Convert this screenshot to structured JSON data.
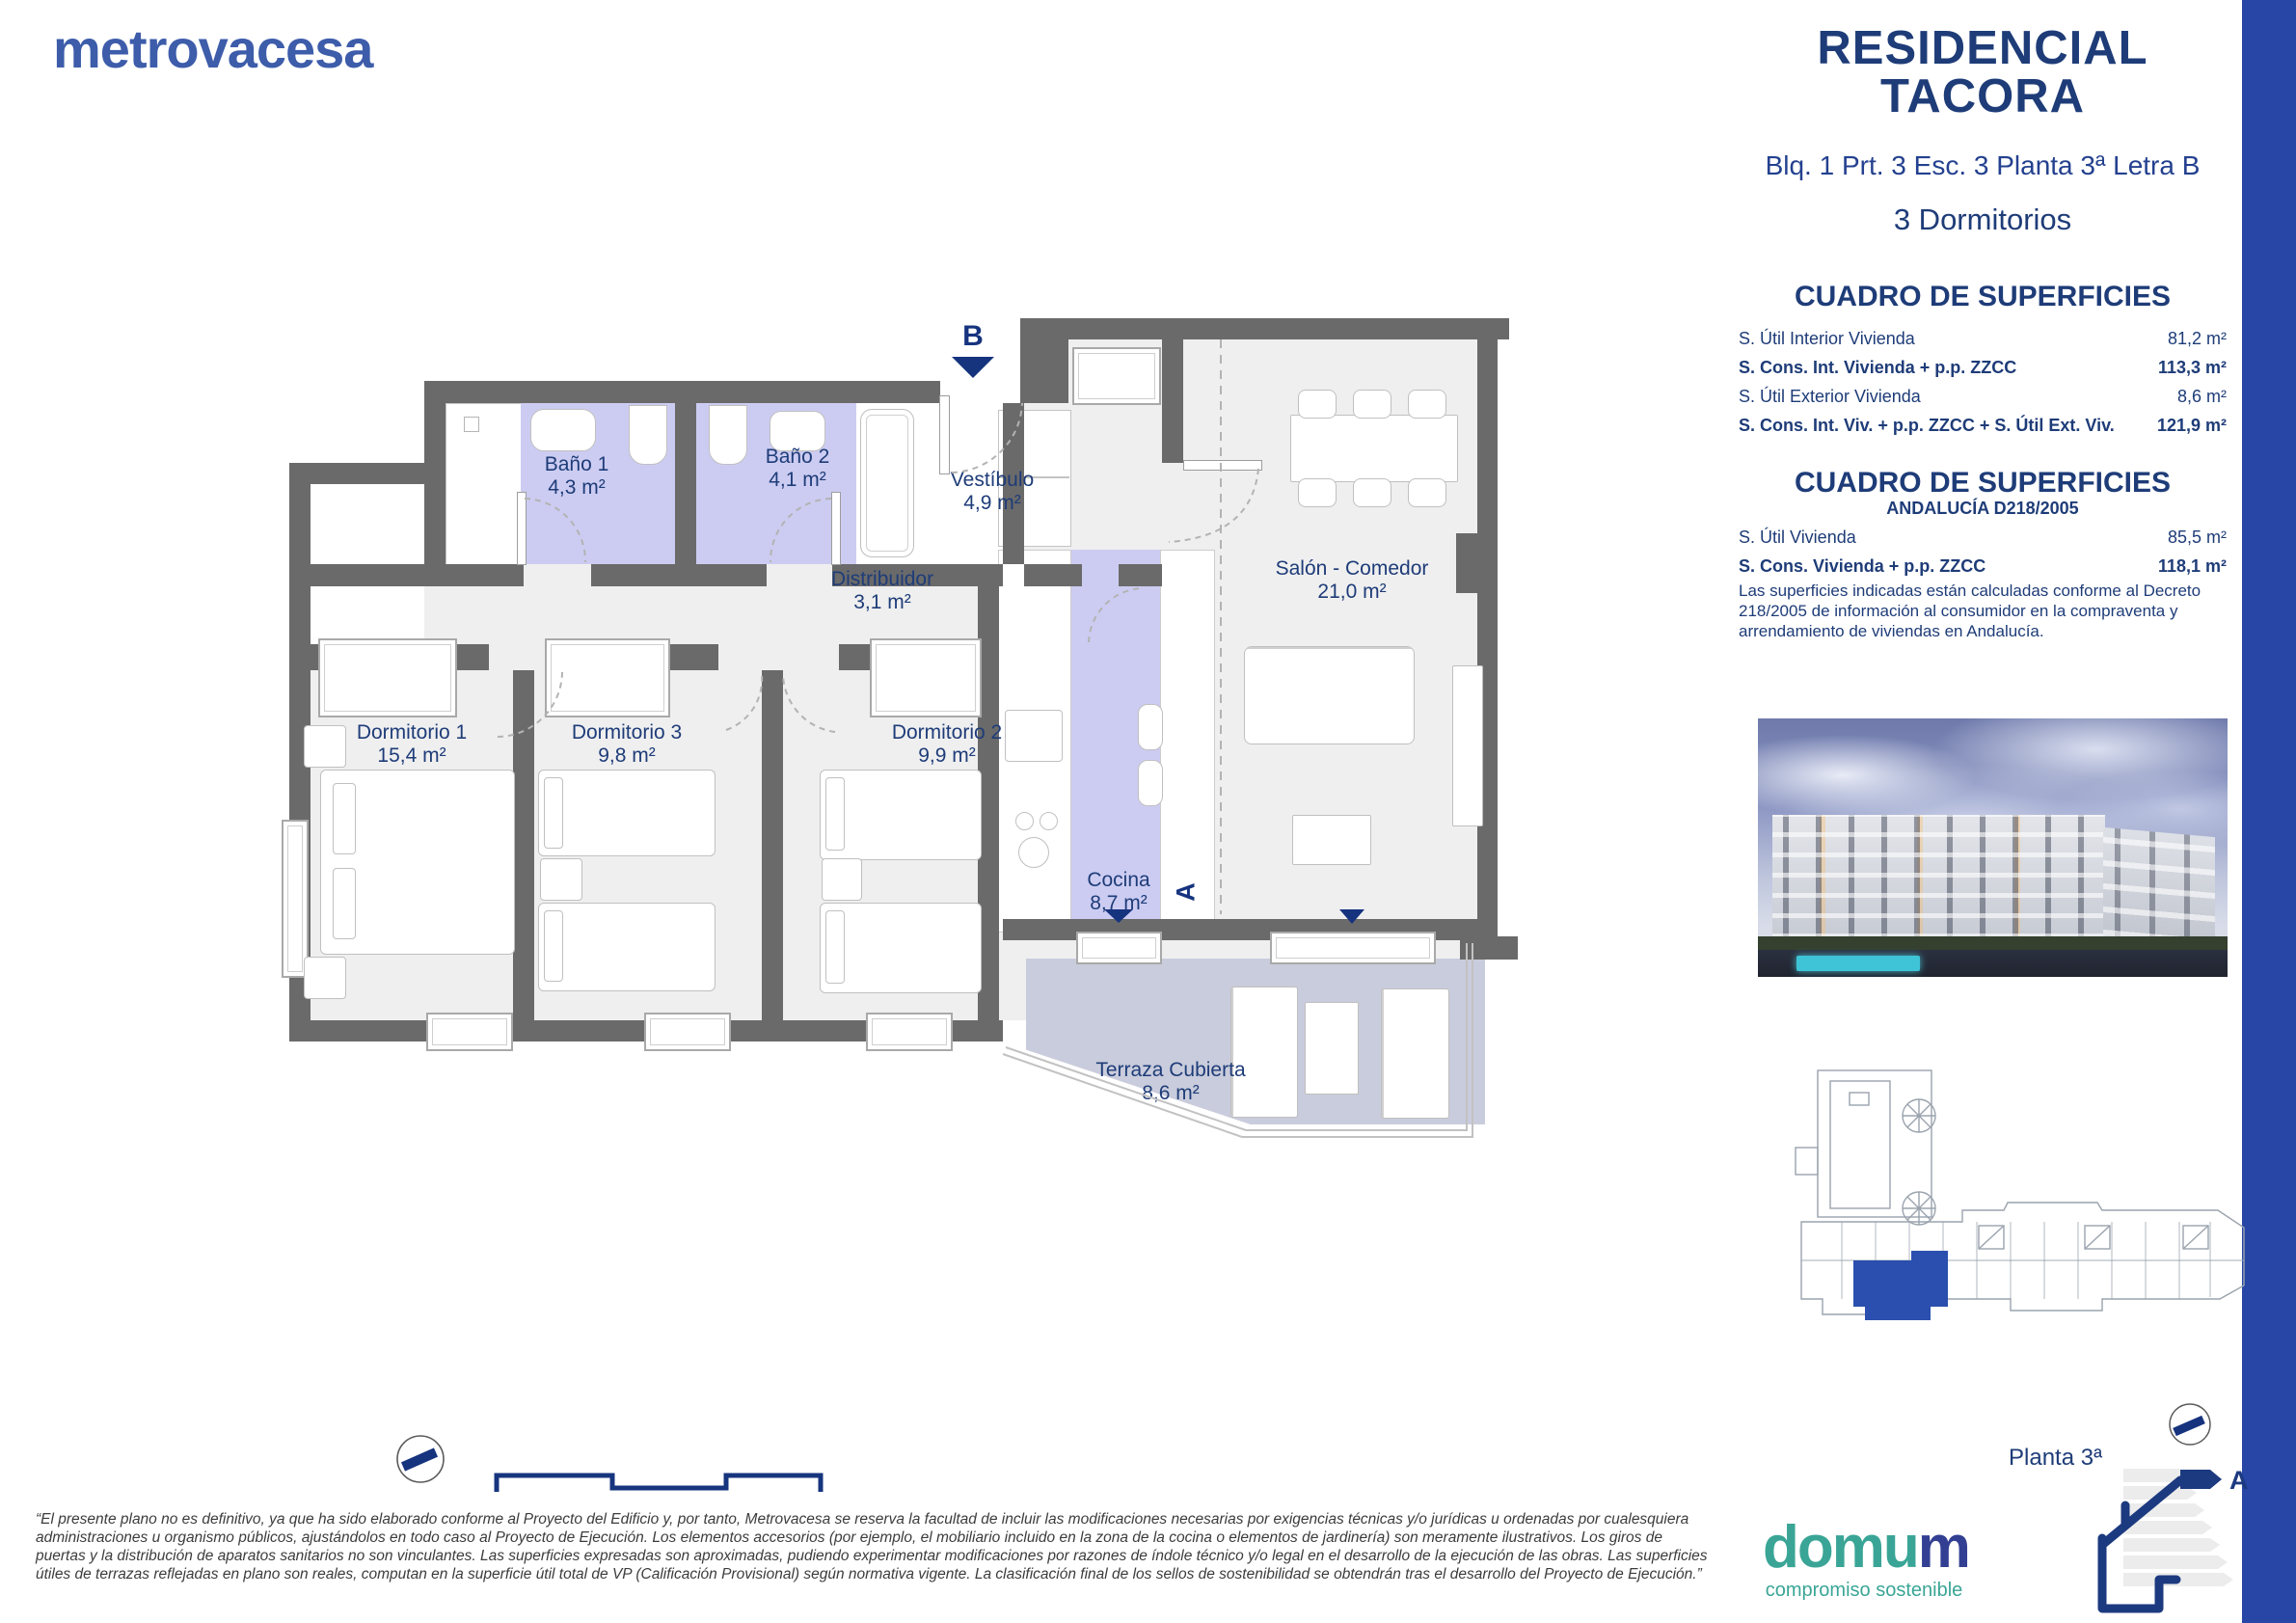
{
  "brand": {
    "logo_text": "metrovacesa",
    "logo_color": "#3d5caa"
  },
  "header": {
    "title_line1": "RESIDENCIAL",
    "title_line2": "TACORA",
    "subtitle": "Blq. 1 Prt. 3 Esc. 3 Planta 3ª Letra B",
    "typology": "3 Dormitorios"
  },
  "surfaces_main": {
    "title": "CUADRO DE SUPERFICIES",
    "rows": [
      {
        "label": "S. Útil Interior Vivienda",
        "value": "81,2 m²"
      },
      {
        "label": "S. Cons. Int. Vivienda + p.p. ZZCC",
        "value": "113,3 m²"
      },
      {
        "label": "S. Útil Exterior Vivienda",
        "value": "8,6 m²"
      },
      {
        "label": "S. Cons. Int. Viv. + p.p. ZZCC + S. Útil Ext. Viv.",
        "value": "121,9 m²"
      }
    ]
  },
  "surfaces_andalucia": {
    "title": "CUADRO DE SUPERFICIES",
    "subtitle": "ANDALUCÍA D218/2005",
    "rows": [
      {
        "label": "S. Útil Vivienda",
        "value": "85,5 m²"
      },
      {
        "label": "S. Cons. Vivienda + p.p. ZZCC",
        "value": "118,1 m²"
      }
    ],
    "note": "Las superficies indicadas están calculadas conforme al Decreto 218/2005 de información al consumidor en la compraventa y arrendamiento de viviendas en Andalucía."
  },
  "floor_plan": {
    "rooms": [
      {
        "name": "Baño 1",
        "area": "4,3 m²"
      },
      {
        "name": "Baño 2",
        "area": "4,1 m²"
      },
      {
        "name": "Vestíbulo",
        "area": "4,9 m²"
      },
      {
        "name": "Distribuidor",
        "area": "3,1 m²"
      },
      {
        "name": "Salón - Comedor",
        "area": "21,0 m²"
      },
      {
        "name": "Dormitorio 1",
        "area": "15,4 m²"
      },
      {
        "name": "Dormitorio 3",
        "area": "9,8 m²"
      },
      {
        "name": "Dormitorio 2",
        "area": "9,9 m²"
      },
      {
        "name": "Cocina",
        "area": "8,7 m²"
      },
      {
        "name": "Terraza Cubierta",
        "area": "8,6 m²"
      }
    ],
    "markers": {
      "section_b": "B",
      "section_a": "A"
    }
  },
  "site_plan": {
    "level_label": "Planta 3ª"
  },
  "footer": {
    "disclaimer": "“El presente plano no es definitivo, ya que ha sido elaborado conforme al Proyecto del Edificio y, por tanto, Metrovacesa se reserva la facultad de incluir las modificaciones necesarias por exigencias técnicas y/o jurídicas u ordenadas por cualesquiera administraciones u organismo públicos, ajustándolos en todo caso al Proyecto de Ejecución. Los elementos accesorios (por ejemplo, el mobiliario incluido en la zona de la cocina o elementos de jardinería) son meramente ilustrativos. Los giros de puertas y la distribución de aparatos sanitarios no son vinculantes. Las superficies expresadas son aproximadas, pudiendo experimentar modificaciones por razones de índole técnico y/o legal en el desarrollo de la ejecución de las obras. Las superficies útiles de terrazas reflejadas en plano son reales, computan en la superficie útil total de VP (Calificación Provisional) según normativa vigente. La clasificación final de los sellos de sostenibilidad se obtendrán tras el desarrollo del Proyecto de Ejecución.”"
  },
  "domum": {
    "word_teal": "domu",
    "word_navy": "m",
    "tagline": "compromiso sostenible"
  },
  "energy": {
    "rating": "A"
  },
  "colors": {
    "accent_bar": "#2746a6",
    "wall": "#6a6a6a",
    "floor": "#efeff0",
    "wet_room": "#ccccf2",
    "terrace": "#c9ccdc",
    "navy": "#1e3c78",
    "teal": "#3aa596"
  }
}
